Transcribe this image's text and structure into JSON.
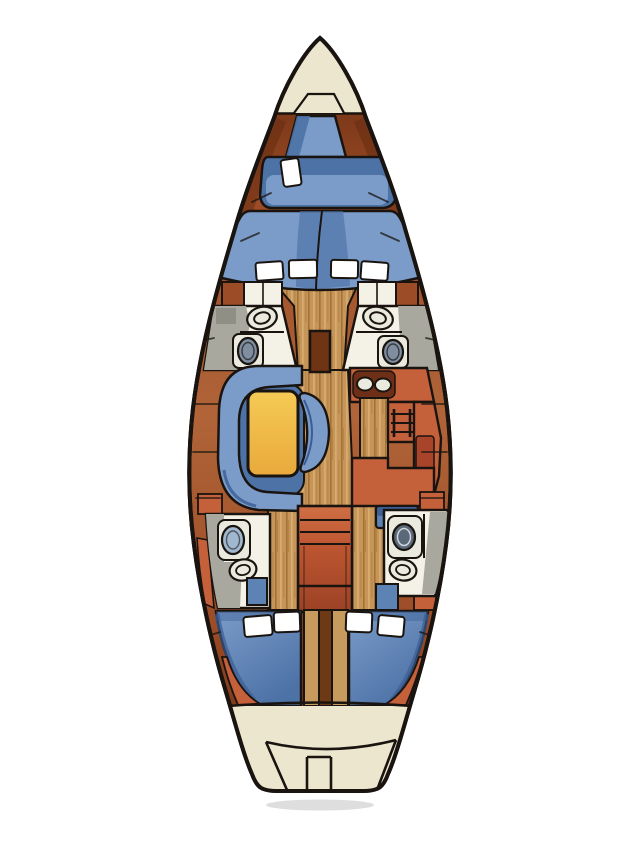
{
  "diagram": {
    "type": "sailboat-interior-floorplan",
    "view": "overhead-deck-plan"
  },
  "palette": {
    "outline": "#1a1410",
    "page_bg": "#ffffff",
    "deck_cream": "#ede6cf",
    "hull_band_dark": "#63290f",
    "hull_band_mid": "#9c4c26",
    "hull_band_light": "#b06438",
    "wood_base": "#c6955a",
    "wood_stripe": "#9e6d2e",
    "wood_light": "#dcb272",
    "wood_dark_post": "#6e3413",
    "divider_tan": "#c79b5e",
    "divider_dark": "#6e3a16",
    "berth_blue": "#7b9cc9",
    "berth_blue_dark": "#4d72a6",
    "berth_blue_deep": "#3a5d94",
    "pillow_white": "#ffffff",
    "head_floor_gray": "#a8a89e",
    "head_floor_dark": "#8f8f85",
    "head_counter_white": "#f4f2e6",
    "fixture_white": "#eaeadf",
    "toilet_blue": "#9fb8cf",
    "toilet_mid": "#7e8ea0",
    "toilet_dark": "#5a6878",
    "table_gold": "#f5ca55",
    "table_gold_dark": "#e9a93c",
    "galley_terracotta": "#c4603a",
    "galley_terracotta_dark": "#a8442a",
    "galley_pad_brown": "#6e2f18",
    "steps_red": "#bc5530",
    "steps_light": "#d06f45",
    "steps_dark": "#9c4226",
    "locker_blue": "#5d83b5",
    "shadow_gray": "#bdbdbd"
  },
  "areas": {
    "bow": [
      {
        "name": "foredeck"
      },
      {
        "name": "anchor-locker"
      }
    ],
    "forward_cabin": [
      {
        "name": "forepeak-berth"
      },
      {
        "name": "v-berth",
        "pillows": 5
      }
    ],
    "midship": [
      {
        "name": "port-forward-head",
        "fixtures": [
          "sink",
          "toilet"
        ]
      },
      {
        "name": "starboard-forward-head",
        "fixtures": [
          "sink",
          "toilet"
        ]
      },
      {
        "name": "mast-post"
      }
    ],
    "salon": [
      {
        "name": "u-settee"
      },
      {
        "name": "dining-table"
      },
      {
        "name": "chair"
      }
    ],
    "galley": [
      {
        "name": "double-sink",
        "basins": 2
      },
      {
        "name": "stove"
      },
      {
        "name": "counters"
      },
      {
        "name": "nav-seat"
      }
    ],
    "companionway": [
      {
        "name": "steps"
      }
    ],
    "aft": [
      {
        "name": "port-aft-head",
        "fixtures": [
          "toilet",
          "sink"
        ]
      },
      {
        "name": "starboard-aft-head",
        "fixtures": [
          "toilet",
          "sink"
        ]
      },
      {
        "name": "port-aft-cabin-berth",
        "pillows": 2
      },
      {
        "name": "starboard-aft-cabin-berth",
        "pillows": 2
      }
    ],
    "stern": [
      {
        "name": "transom"
      },
      {
        "name": "swim-platform"
      },
      {
        "name": "boarding-step"
      }
    ],
    "totals": {
      "berths": 4,
      "heads": 4,
      "toilets": 4,
      "sinks": 6,
      "pillows": 9
    }
  }
}
